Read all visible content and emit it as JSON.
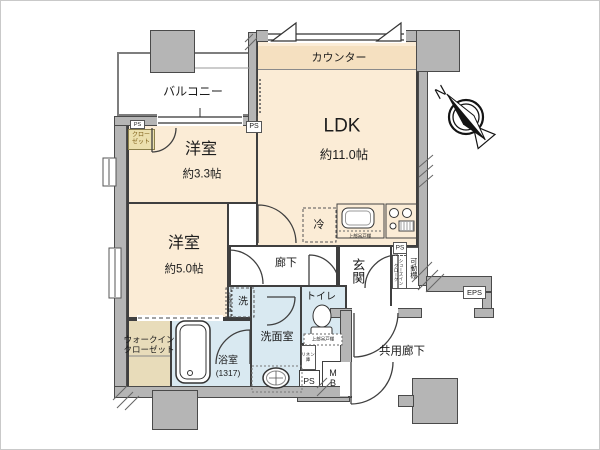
{
  "rooms": {
    "balcony": {
      "label": "バルコニー"
    },
    "counter": {
      "label": "カウンター"
    },
    "ldk": {
      "label": "LDK",
      "size": "約11.0帖"
    },
    "bedroom_33": {
      "label": "洋室",
      "size": "約3.3帖"
    },
    "bedroom_50": {
      "label": "洋室",
      "size": "約5.0帖"
    },
    "hallway": {
      "label": "廊下"
    },
    "entrance": {
      "label": "玄関"
    },
    "toilet": {
      "label": "トイレ"
    },
    "washroom": {
      "label": "洗面室"
    },
    "bathroom": {
      "label": "浴室",
      "size": "(1317)"
    },
    "common_corridor": {
      "label": "共用廊下"
    }
  },
  "storage": {
    "closet": {
      "line1": "クロー",
      "line2": "ゼット"
    },
    "walk_in_closet": {
      "line1": "ウォークイン",
      "line2": "クローゼット"
    },
    "shoes_in_cloak": {
      "line1": "シューズイン",
      "line2": "クローク"
    },
    "movable_shelf": {
      "label": "可動棚"
    },
    "linen": {
      "line1": "リネン",
      "line2": "庫"
    }
  },
  "fixtures": {
    "refrigerator": {
      "label": "冷"
    },
    "washer": {
      "label": "洗"
    },
    "upper_cabinet_kitchen": {
      "label": "上部吊戸棚"
    },
    "upper_cabinet_toilet": {
      "label": "上部吊戸棚"
    },
    "upper_cabinet_washer": {
      "label": "上部吊戸棚"
    }
  },
  "utility": {
    "ps1": {
      "label": "PS"
    },
    "ps2": {
      "label": "PS"
    },
    "ps3": {
      "label": "PS"
    },
    "ps4": {
      "label": "PS"
    },
    "eps": {
      "label": "EPS"
    },
    "mb": {
      "line1": "M",
      "line2": "B"
    }
  },
  "compass": {
    "label": "N"
  },
  "colors": {
    "room_cream": "#fbecd6",
    "counter": "#f5e0c0",
    "room_wet": "#d9e9f1",
    "room_tan": "#e8dcba",
    "closet_yellow": "#ece0ae",
    "wall": "#b5b5b5",
    "wall_edge": "#4a4a4a",
    "line": "#3f3f3f"
  }
}
